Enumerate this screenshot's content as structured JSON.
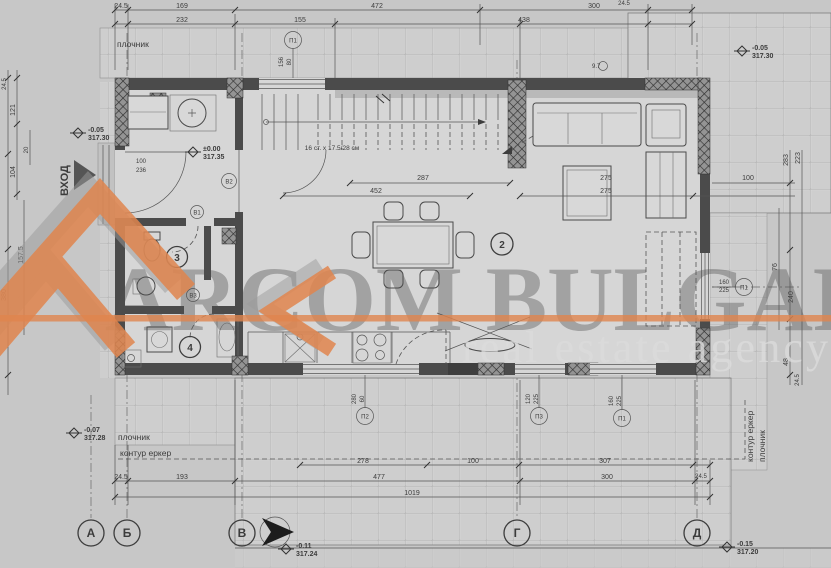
{
  "watermark": {
    "brand": "ARCOM BULGARIA",
    "tagline": "real estate agency",
    "accent": "#E0854E"
  },
  "labels": {
    "entrance": "ВХОД",
    "pavement_top": "плочник",
    "pavement_bottom": "плочник",
    "pavement_right": "плочник",
    "bay_bottom": "контур еркер",
    "bay_right": "контур еркер",
    "stairs": "16 ст. х 17.5/28 см",
    "light_point": "9.7"
  },
  "axes": [
    "А",
    "Б",
    "В",
    "Г",
    "Д"
  ],
  "rooms": [
    "2",
    "3",
    "4"
  ],
  "elevations": {
    "top_left": {
      "rel": "-0.05",
      "abs": "317.30"
    },
    "top_right": {
      "rel": "-0.05",
      "abs": "317.30"
    },
    "entry": {
      "rel": "±0.00",
      "abs": "317.35"
    },
    "bottom_left": {
      "rel": "-0.07",
      "abs": "317.28"
    },
    "bottom_mid": {
      "rel": "-0.11",
      "abs": "317.24"
    },
    "bottom_right": {
      "rel": "-0.15",
      "abs": "317.20"
    }
  },
  "openings": [
    {
      "id": "П1",
      "a": "156",
      "b": "80"
    },
    {
      "id": "П1",
      "a": "160",
      "b": "225"
    },
    {
      "id": "П2",
      "a": "280",
      "b": "60"
    },
    {
      "id": "П3",
      "a": "120",
      "b": "225"
    },
    {
      "id": "П1",
      "a": "160",
      "b": "225"
    }
  ],
  "doors": [
    {
      "id": "В1"
    },
    {
      "id": "В2"
    },
    {
      "id": "В3"
    }
  ],
  "dims": {
    "top": [
      "24.5",
      "169",
      "472",
      "300",
      "24.5",
      "232",
      "155",
      "438"
    ],
    "bottom": [
      "24.5",
      "193",
      "278",
      "100",
      "477",
      "300",
      "1019",
      "307",
      "24.5"
    ],
    "left": [
      "24.5",
      "121",
      "20",
      "104",
      "157.5",
      "380"
    ],
    "right": [
      "283",
      "223",
      "76",
      "240",
      "48",
      "24.5",
      "100"
    ],
    "interior": [
      "452",
      "287",
      "275",
      "275",
      "100",
      "236"
    ]
  }
}
